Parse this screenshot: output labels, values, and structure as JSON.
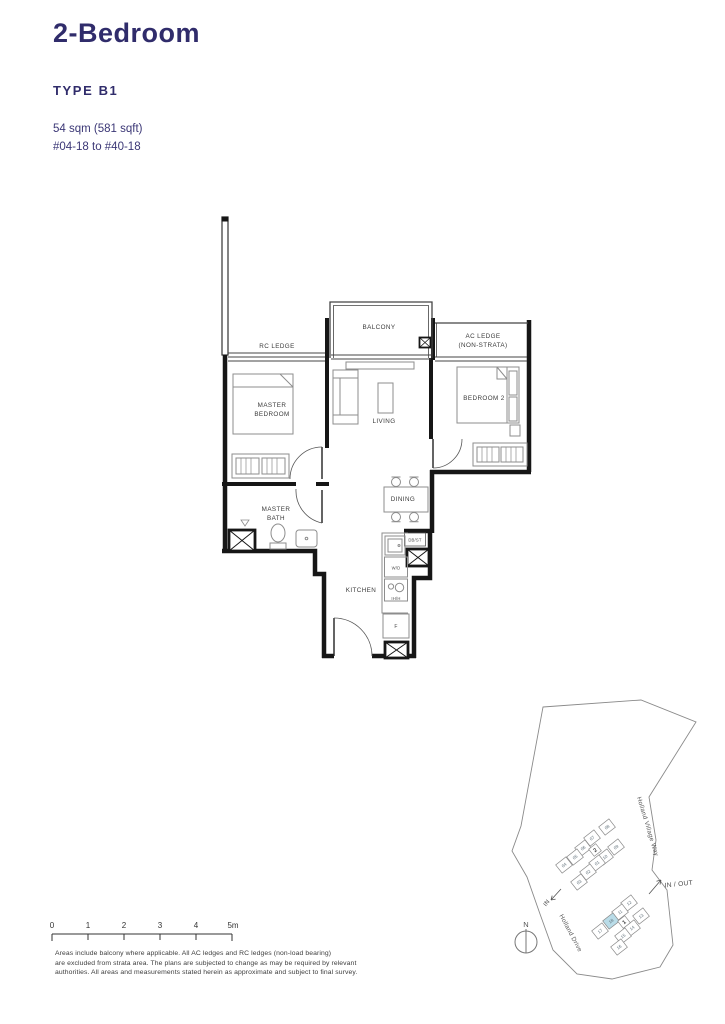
{
  "header": {
    "title": "2-Bedroom",
    "type": "TYPE B1",
    "area": "54 sqm (581 sqft)",
    "stack": "#04-18 to #40-18"
  },
  "floorplan": {
    "labels": {
      "rc_ledge": "RC LEDGE",
      "balcony": "BALCONY",
      "ac_ledge_1": "AC LEDGE",
      "ac_ledge_2": "(NON-STRATA)",
      "master_1": "MASTER",
      "master_2": "BEDROOM",
      "living": "LIVING",
      "bedroom2": "BEDROOM 2",
      "bath_1": "MASTER",
      "bath_2": "BATH",
      "dining": "DINING",
      "kitchen": "KITCHEN",
      "db_st": "DB/ST",
      "wd": "W/D",
      "hob": "IH/H",
      "fridge": "F"
    }
  },
  "scalebar": {
    "ticks": [
      "0",
      "1",
      "2",
      "3",
      "4",
      "5m"
    ]
  },
  "disclaimer": {
    "line1": "Areas include balcony where applicable. All AC ledges and RC ledges (non-load bearing)",
    "line2": "are excluded from strata area. The plans are subjected to change as may be required by relevant",
    "line3": "authorities. All areas and measurements stated herein as approximate and subject to final survey."
  },
  "sitemap": {
    "north": "N",
    "in_out": "IN / OUT",
    "in": "IN",
    "road1": "Holland Village Way",
    "road2": "Holland Drive",
    "block2_label": "2",
    "block1_label": "1",
    "units": [
      "08",
      "07",
      "09",
      "06",
      "05",
      "10",
      "04",
      "01",
      "02",
      "03",
      "12",
      "11",
      "13",
      "18",
      "14",
      "17",
      "15",
      "16"
    ],
    "highlighted_unit": "18",
    "highlight_color": "#b9dce8"
  },
  "colors": {
    "accent": "#302c6b",
    "plan_line": "#1a1a1a",
    "furniture": "#8d8d8d",
    "map_line": "#8a8a8a"
  }
}
